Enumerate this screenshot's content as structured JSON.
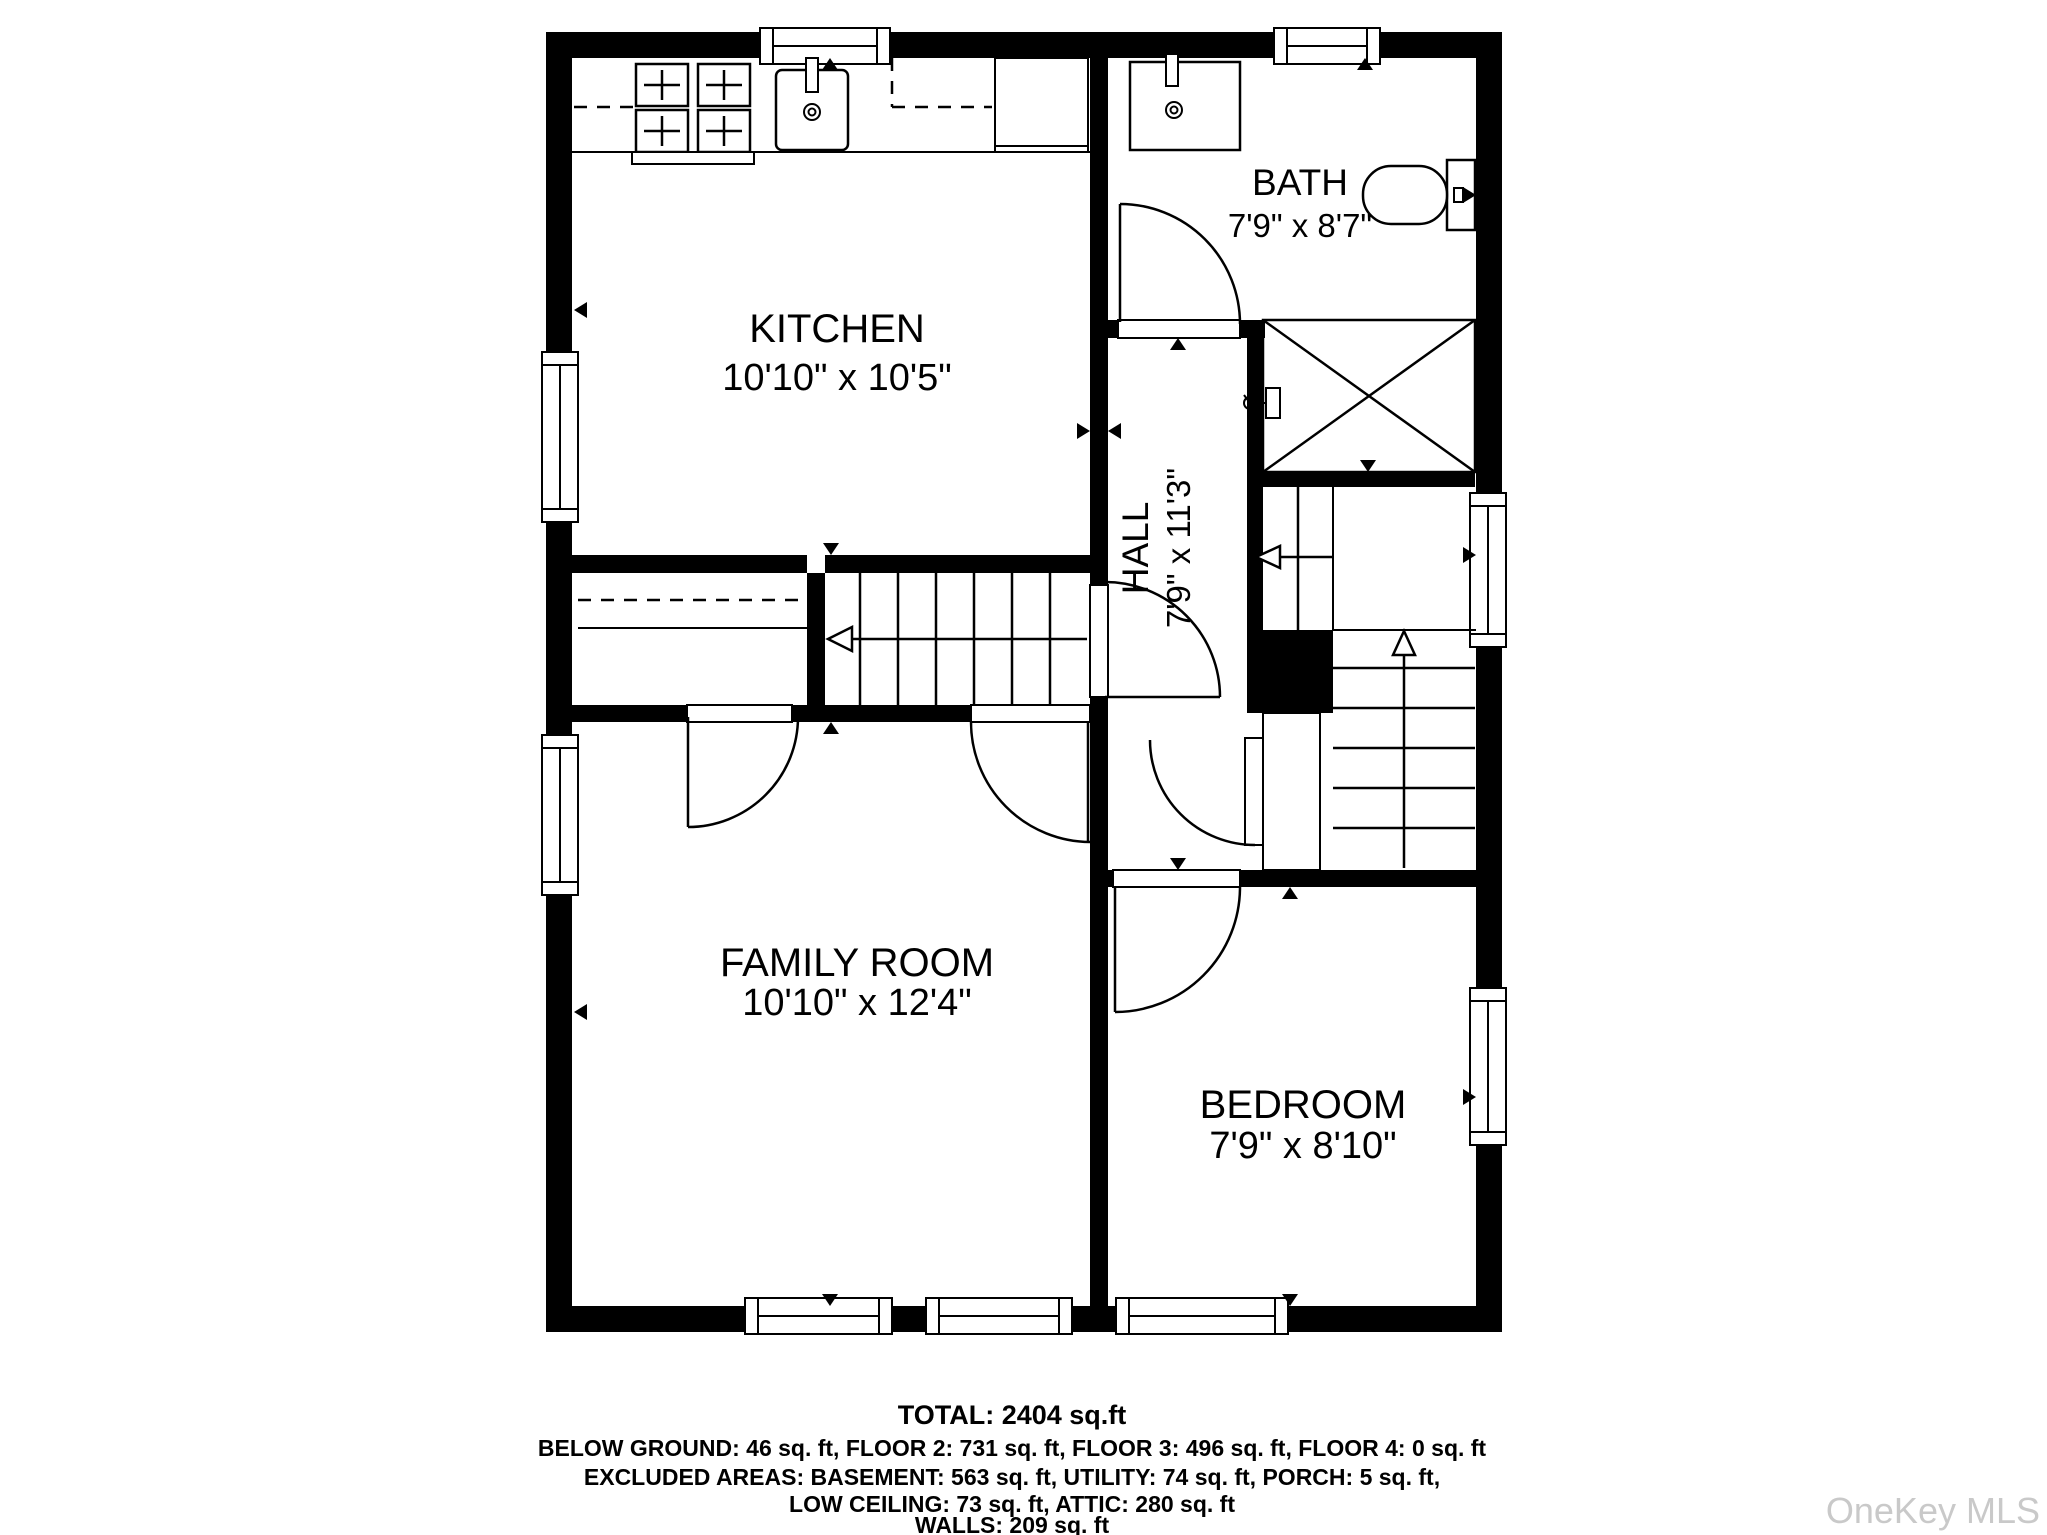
{
  "plan": {
    "rooms": [
      {
        "name": "KITCHEN",
        "dims": "10'10\" x 10'5\""
      },
      {
        "name": "BATH",
        "dims": "7'9\" x 8'7\""
      },
      {
        "name": "HALL",
        "dims": "7'9\" x 11'3\""
      },
      {
        "name": "FAMILY ROOM",
        "dims": "10'10\" x 12'4\""
      },
      {
        "name": "BEDROOM",
        "dims": "7'9\" x 8'10\""
      }
    ]
  },
  "footer": {
    "total": "TOTAL: 2404 sq.ft",
    "line1": "BELOW GROUND: 46 sq. ft, FLOOR 2: 731 sq. ft, FLOOR 3: 496 sq. ft, FLOOR 4: 0 sq. ft",
    "line2": "EXCLUDED AREAS: BASEMENT: 563 sq. ft, UTILITY: 74 sq. ft, PORCH: 5 sq. ft,",
    "line3": "LOW CEILING: 73 sq. ft, ATTIC: 280 sq. ft",
    "line4": "WALLS: 209 sq. ft"
  },
  "watermark": "OneKey MLS",
  "colors": {
    "wall": "#000000",
    "watermark": "#c9c9c9"
  }
}
